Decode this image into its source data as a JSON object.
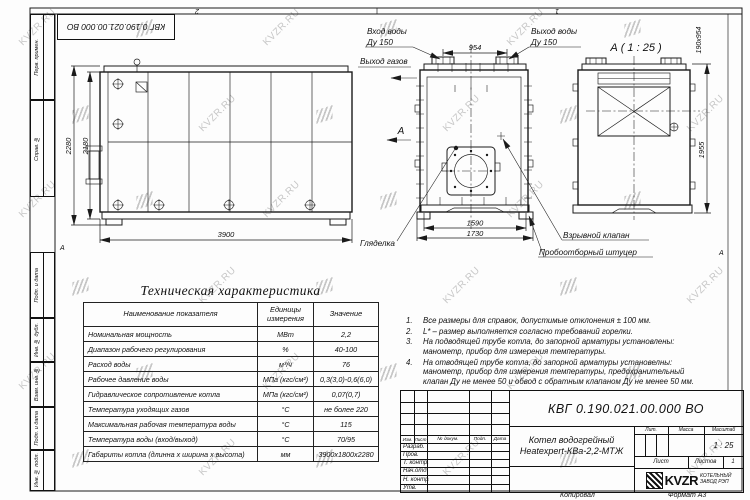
{
  "meta": {
    "top_doc_number": "КВГ 0.190.021.00.000 ВО",
    "zone_top_left": "2",
    "zone_top_right": "1",
    "zone_row_left": "А",
    "zone_row_right": "А"
  },
  "watermark": {
    "text": "KVZR.RU"
  },
  "sidebar": {
    "top": [
      "Перв. примен.",
      "Справ. №"
    ],
    "bottom": [
      "Подп. и дата",
      "Инв. № дубл.",
      "Взам. инв. №",
      "Подп. и дата",
      "Инв. № подл."
    ]
  },
  "views": {
    "side": {
      "dims": {
        "height_outer": "2280",
        "height_inner": "2180",
        "length": "3900"
      }
    },
    "front": {
      "labels": {
        "water_in": "Вход воды",
        "water_in_dn": "Ду 150",
        "water_out": "Выход воды",
        "water_out_dn": "Ду 150",
        "gas_out": "Выход газов",
        "view_arrow": "А",
        "sight": "Гляделка",
        "burst_valve": "Взрывной клапан",
        "sampler": "Пробоотборный штуцер"
      },
      "dims": {
        "flange_span": "954",
        "width_inner": "1590",
        "width_outer": "1730"
      }
    },
    "detail": {
      "title": "А ( 1 : 25 )",
      "dims": {
        "opening": "190х954",
        "height": "1955"
      }
    }
  },
  "table": {
    "title": "Техническая характеристика",
    "headers": [
      "Наименование показателя",
      "Единицы измерения",
      "Значение"
    ],
    "rows": [
      [
        "Номинальная мощность",
        "МВт",
        "2,2"
      ],
      [
        "Диапазон рабочего регулирования",
        "%",
        "40-100"
      ],
      [
        "Расход воды",
        "м³/ч",
        "76"
      ],
      [
        "Рабочее давление воды",
        "МПа (кгс/см²)",
        "0,3(3,0)-0,6(6,0)"
      ],
      [
        "Гидравлическое сопротивление котла",
        "МПа (кгс/см²)",
        "0,07(0,7)"
      ],
      [
        "Температура уходящих газов",
        "°С",
        "не более 220"
      ],
      [
        "Максимальная рабочая температура воды",
        "°С",
        "115"
      ],
      [
        "Температура воды (вход/выход)",
        "°С",
        "70/95"
      ],
      [
        "Габариты котла (длинна х ширина х высота)",
        "мм",
        "3900х1800х2280"
      ]
    ]
  },
  "notes": {
    "items": [
      "Все размеры для справок, допустимые отклонения ± 100 мм.",
      "L* – размер выполняется согласно требований горелки.",
      "На подводящей трубе котла, до запорной арматуры установлены: манометр, прибор для измерения температуры.",
      "На отводящей трубе котла, до запорной арматуры установелны: манометр, прибор для измерения температуры, предохранительный клапан Ду не менее 50 и обвод с обратным клапаном Ду не менее 50 мм."
    ]
  },
  "titleblock": {
    "doc_number": "КВГ 0.190.021.00.000 ВО",
    "product_name_1": "Котел водогрейный",
    "product_name_2": "Heatexpert-КВа-2,2-МТЖ",
    "header_cols": [
      "Изм.",
      "Лист",
      "№ докум.",
      "Подп.",
      "Дата"
    ],
    "row_labels": [
      "Разраб.",
      "Пров.",
      "Т. контр.",
      "Нач.отд.",
      "Н. контр.",
      "Утв."
    ],
    "lit_label": "Лит.",
    "mass_label": "Масса",
    "scale_label": "Масштаб",
    "scale_value": "1 : 25",
    "sheet_label": "Лист",
    "sheets_label": "Листов",
    "sheets_value": "1",
    "company_logo": "KVZR",
    "company_name_1": "КОТЕЛЬНЫЙ",
    "company_name_2": "ЗАВОД РЭП",
    "footer_copy": "Копировал",
    "footer_format": "Формат А3"
  }
}
